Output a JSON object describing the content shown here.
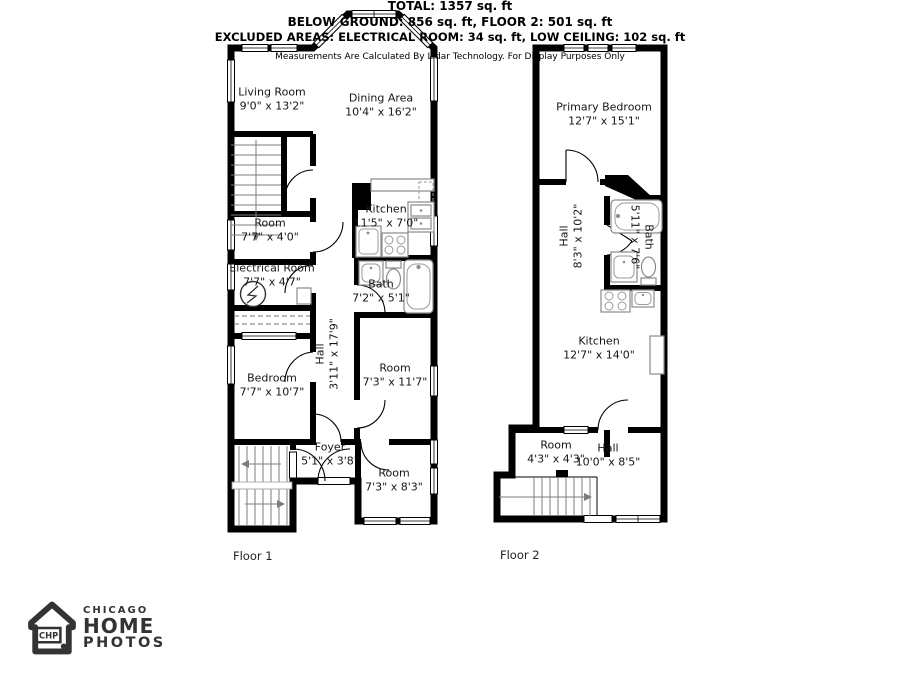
{
  "floor1": {
    "label": "Floor 1",
    "rooms": {
      "living_room": {
        "name": "Living Room",
        "dims": "9'0\" x 13'2\""
      },
      "dining_area": {
        "name": "Dining Area",
        "dims": "10'4\" x 16'2\""
      },
      "room_a": {
        "name": "Room",
        "dims": "7'7\" x 4'0\""
      },
      "electrical_room": {
        "name": "Electrical Room",
        "dims": "7'7\" x 4'7\""
      },
      "kitchen": {
        "name": "Kitchen",
        "dims": "11'5\" x 7'0\""
      },
      "bath": {
        "name": "Bath",
        "dims": "7'2\" x 5'1\""
      },
      "hall": {
        "name": "Hall",
        "dims": "3'11\" x 17'9\""
      },
      "bedroom": {
        "name": "Bedroom",
        "dims": "7'7\" x 10'7\""
      },
      "room_b": {
        "name": "Room",
        "dims": "7'3\" x 11'7\""
      },
      "foyer": {
        "name": "Foyer",
        "dims": "5'1\" x 3'8\""
      },
      "room_c": {
        "name": "Room",
        "dims": "7'3\" x 8'3\""
      }
    }
  },
  "floor2": {
    "label": "Floor 2",
    "rooms": {
      "primary_bedroom": {
        "name": "Primary Bedroom",
        "dims": "12'7\" x 15'1\""
      },
      "hall_upper": {
        "name": "Hall",
        "dims": "8'3\" x 10'2\""
      },
      "bath": {
        "name": "Bath",
        "dims": "5'11\" x 7'6\""
      },
      "kitchen": {
        "name": "Kitchen",
        "dims": "12'7\" x 14'0\""
      },
      "room": {
        "name": "Room",
        "dims": "4'3\" x 4'3\""
      },
      "hall_lower": {
        "name": "Hall",
        "dims": "10'0\" x 8'5\""
      }
    }
  },
  "logo": {
    "brand_top": "CHICAGO",
    "brand_mid": "HOME",
    "brand_bottom": "PHOTOS",
    "badge": "CHP"
  },
  "summary": {
    "total": "TOTAL: 1357 sq. ft",
    "areas": "BELOW GROUND: 856 sq. ft, FLOOR 2: 501 sq. ft",
    "excluded": "EXCLUDED AREAS: ELECTRICAL ROOM: 34 sq. ft, LOW CEILING: 102 sq. ft",
    "disclaimer": "Measurements Are Calculated By Lidar Technology. For Display Purposes Only"
  }
}
